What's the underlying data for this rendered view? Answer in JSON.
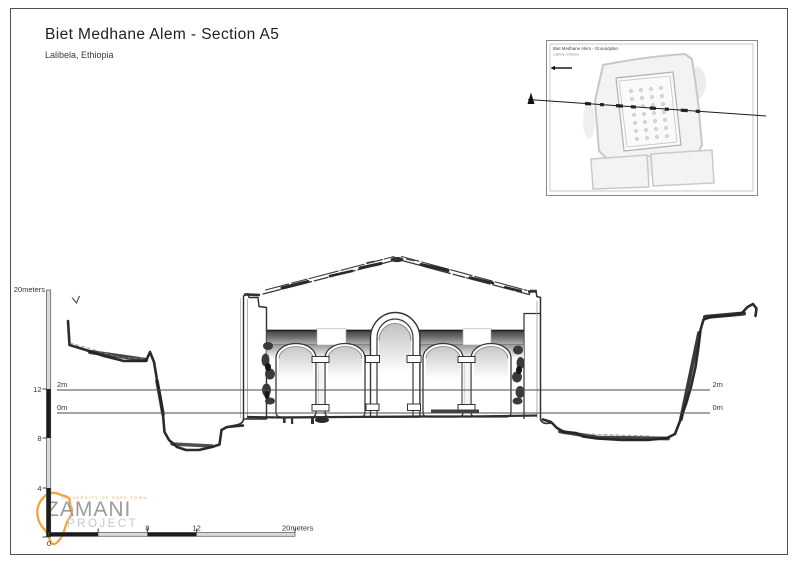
{
  "header": {
    "title": "Biet Medhane Alem - Section A5",
    "subtitle": "Lalibela, Ethiopia"
  },
  "inset_map": {
    "title": "Biet Medhane Alem - Groundplan",
    "subtitle": "Lalibela, Ethiopia"
  },
  "reference_lines": {
    "upper_label": "2m",
    "lower_label": "0m"
  },
  "vertical_scale": {
    "unit_label": "20meters",
    "ticks": [
      "12",
      "8",
      "4",
      "0"
    ]
  },
  "horizontal_scale": {
    "ticks": [
      "8",
      "12"
    ],
    "unit_label": "20meters"
  },
  "logo": {
    "university": "UNIVERSITY OF CAPE TOWN",
    "name": "ZAMANI",
    "subtitle": "PROJECT"
  },
  "colors": {
    "ink": "#2e2e2e",
    "terrain": "#2b2b2b",
    "scale_dark": "#1c1c1c",
    "scale_light": "#d9d9d9",
    "logo_orange": "#f0a63e",
    "logo_gray": "#9b9b9b",
    "inset_gray": "#c6c6c6"
  }
}
